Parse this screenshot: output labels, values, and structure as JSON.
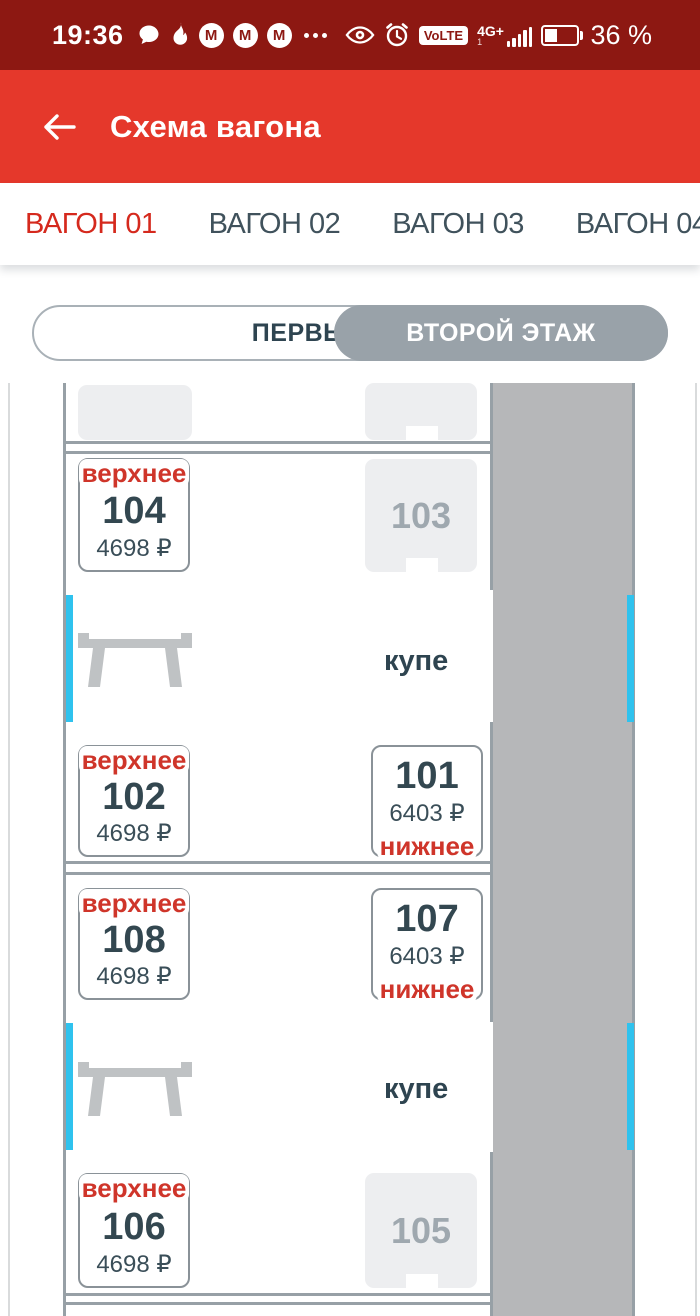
{
  "status_bar": {
    "time": "19:36",
    "volte_label": "VoLTE",
    "network_label": "4G+",
    "sim_label": "1",
    "battery_label": "36 %"
  },
  "app_bar": {
    "title": "Схема вагона"
  },
  "tabs": {
    "t1": "ВАГОН 01",
    "t2": "ВАГОН 02",
    "t3": "ВАГОН 03",
    "t4": "ВАГОН 04",
    "active": "ВАГОН 01"
  },
  "floor_toggle": {
    "first": "ПЕРВЫЙ ЭТАЖ",
    "second": "ВТОРОЙ ЭТАЖ",
    "selected": "ВТОРОЙ ЭТАЖ"
  },
  "map": {
    "compartments": {
      "a": {
        "label": "купе",
        "seats": {
          "s104": {
            "number": "104",
            "berth": "верхнее",
            "price": "4698 ₽",
            "status": "available"
          },
          "s103": {
            "number": "103",
            "status": "occupied"
          },
          "s102": {
            "number": "102",
            "berth": "верхнее",
            "price": "4698 ₽",
            "status": "available"
          },
          "s101": {
            "number": "101",
            "berth": "нижнее",
            "price": "6403 ₽",
            "status": "available"
          }
        }
      },
      "b": {
        "label": "купе",
        "seats": {
          "s108": {
            "number": "108",
            "berth": "верхнее",
            "price": "4698 ₽",
            "status": "available"
          },
          "s107": {
            "number": "107",
            "berth": "нижнее",
            "price": "6403 ₽",
            "status": "available"
          },
          "s106": {
            "number": "106",
            "berth": "верхнее",
            "price": "4698 ₽",
            "status": "available"
          },
          "s105": {
            "number": "105",
            "status": "occupied"
          }
        }
      }
    },
    "colors": {
      "statusbar_red": "#8D1812",
      "appbar_red": "#E5382B",
      "accent_red": "#D5291D",
      "berth_red": "#CF352A",
      "slate_text": "#334750",
      "toggle_gray": "#99A2A9",
      "corridor_gray": "#B6B7B9",
      "wall_gray": "#97A0A6",
      "occupied_seat": "#EDEEF0",
      "window_cyan": "#2FC2EE"
    }
  }
}
